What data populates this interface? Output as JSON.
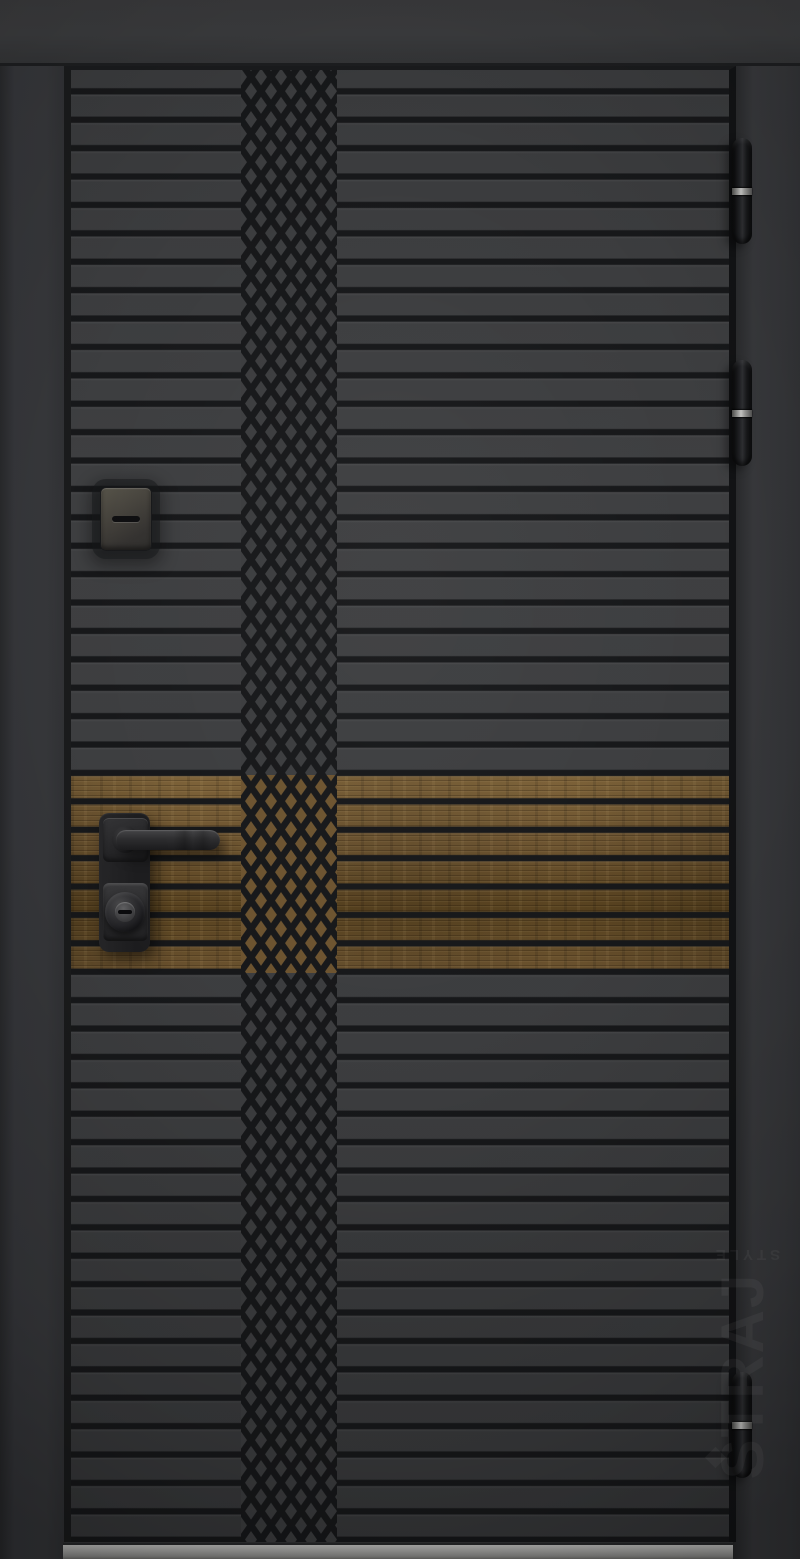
{
  "brand": {
    "name": "STRAJ",
    "subtitle": "STYLE"
  },
  "door": {
    "style": "modern entrance door, horizontal slat milling",
    "pattern": "central diamond lattice band",
    "accent": "horizontal wood insert band",
    "hinges_count": 3
  },
  "hardware": {
    "peephole": "peephole-cover-flap",
    "handle": "square-rosette lever handle",
    "lock": "round cylinder keyhole",
    "threshold": "stainless steel threshold"
  },
  "colors": {
    "wall": "#333436",
    "lintel": "#3a3b3d",
    "frame_right": "#343538",
    "door_face": "#3c3d3f",
    "groove": "#17181a",
    "wood": "#6d5430",
    "wood_light": "#7d6238",
    "wood_dark": "#58421f",
    "hardware_dark": "#202022",
    "hinge_ring": "#c7c7c5",
    "threshold": "#a8a8a6",
    "logo_emboss": "rgba(255,255,255,0.055)"
  }
}
